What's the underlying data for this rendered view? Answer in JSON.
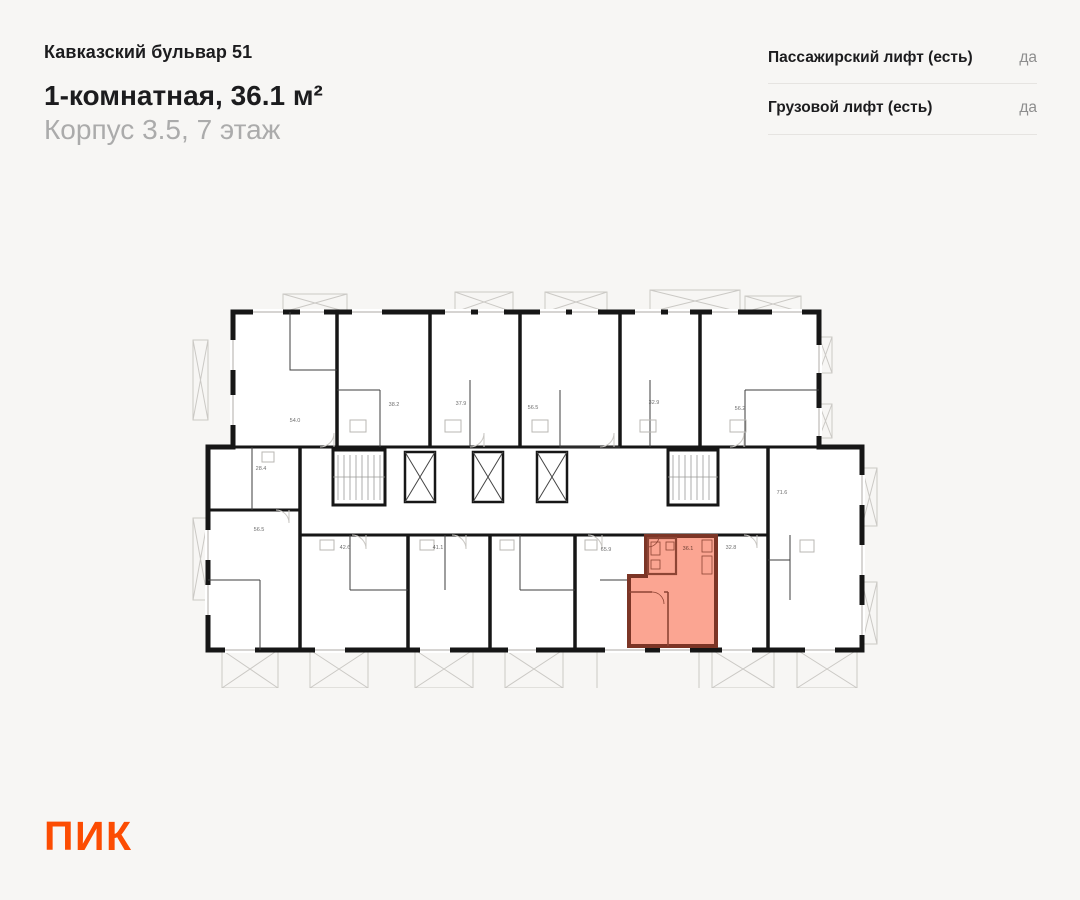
{
  "header": {
    "project": "Кавказский бульвар 51",
    "title": "1-комнатная, 36.1 м²",
    "subtitle": "Корпус 3.5, 7 этаж"
  },
  "info_panel": {
    "rows": [
      {
        "label": "Пассажирский лифт (есть)",
        "value": "да"
      },
      {
        "label": "Грузовой лифт (есть)",
        "value": "да"
      }
    ]
  },
  "logo": {
    "text": "ПИК",
    "color": "#FC4C02"
  },
  "plan": {
    "colors": {
      "walls": "#161616",
      "light": "#CBC9C5",
      "room_fill": "#FFFFFF",
      "highlight_fill": "#FBA592",
      "highlight_stroke": "#7C3526",
      "highlight_inner": "#8D4434",
      "label": "#6E6E6E",
      "highlight_label": "#6E4034"
    },
    "highlight": {
      "label": "36.1",
      "label_x": 688,
      "label_y": 550
    },
    "unit_labels": [
      {
        "text": "54.0",
        "x": 295,
        "y": 422
      },
      {
        "text": "38.2",
        "x": 394,
        "y": 406
      },
      {
        "text": "37.9",
        "x": 461,
        "y": 405
      },
      {
        "text": "56.5",
        "x": 533,
        "y": 409
      },
      {
        "text": "32.9",
        "x": 654,
        "y": 404
      },
      {
        "text": "56.2",
        "x": 740,
        "y": 410
      },
      {
        "text": "28.4",
        "x": 261,
        "y": 470
      },
      {
        "text": "71.6",
        "x": 782,
        "y": 494
      },
      {
        "text": "56.5",
        "x": 259,
        "y": 531
      },
      {
        "text": "42.6",
        "x": 345,
        "y": 549
      },
      {
        "text": "41.1",
        "x": 438,
        "y": 549
      },
      {
        "text": "65.9",
        "x": 606,
        "y": 551
      },
      {
        "text": "32.8",
        "x": 731,
        "y": 549
      }
    ]
  }
}
